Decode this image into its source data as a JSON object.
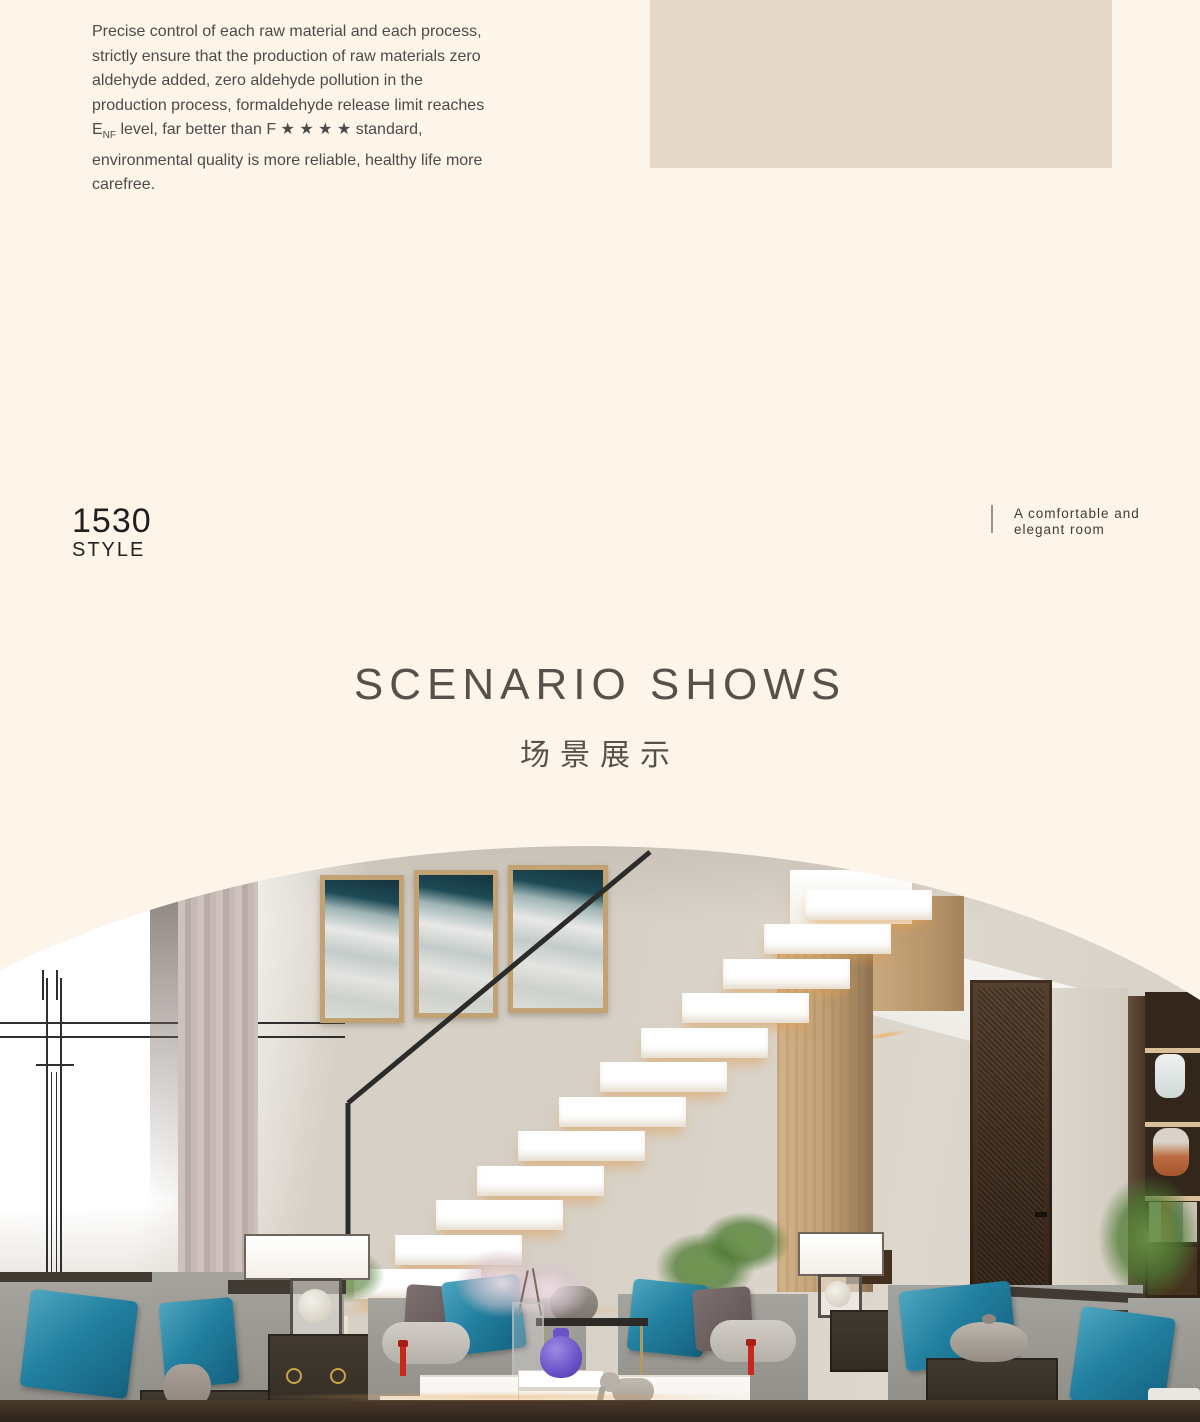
{
  "colors": {
    "page_bg": "#fdf5ea",
    "beige_block": "#e6d8c8",
    "heading_text": "#57514b",
    "body_text": "#4b4b4b",
    "accent_teal": "#2280a0"
  },
  "intro_paragraph": {
    "text_start": "Precise control of each raw material and each process, strictly ensure that the production of raw materials zero aldehyde added, zero aldehyde pollution in the production process, formaldehyde release limit reaches E",
    "subscript": "NF",
    "text_end": " level, far better than F ★ ★ ★ ★ standard, environmental quality is more reliable, healthy life more carefree."
  },
  "style_badge": {
    "number": "1530",
    "label": "STYLE"
  },
  "room_caption": {
    "line1": "A comfortable and",
    "line2": "elegant room"
  },
  "scenario_heading": {
    "title": "SCENARIO SHOWS",
    "subtitle": "场景展示"
  }
}
